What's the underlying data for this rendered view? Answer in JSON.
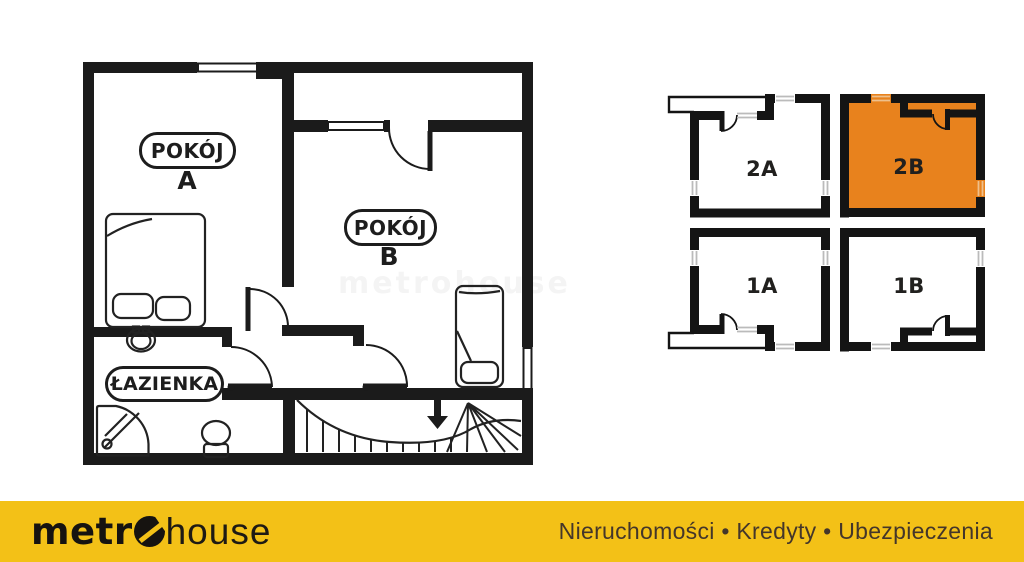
{
  "floor_plan": {
    "room_a": {
      "pill": "POKÓJ",
      "letter": "A"
    },
    "room_b": {
      "pill": "POKÓJ",
      "letter": "B"
    },
    "bathroom": {
      "pill": "ŁAZIENKA"
    },
    "watermark": "metrohouse",
    "wall_color": "#1b1b1b"
  },
  "unit_key": {
    "highlight_color": "#E8821D",
    "units": [
      {
        "label": "2A",
        "highlighted": false
      },
      {
        "label": "2B",
        "highlighted": true
      },
      {
        "label": "1A",
        "highlighted": false
      },
      {
        "label": "1B",
        "highlighted": false
      }
    ]
  },
  "footer": {
    "bg_color": "#F3C117",
    "logo": {
      "bold": "metr",
      "o": "o",
      "light": "house"
    },
    "tagline": "Nieruchomości • Kredyty • Ubezpieczenia"
  }
}
